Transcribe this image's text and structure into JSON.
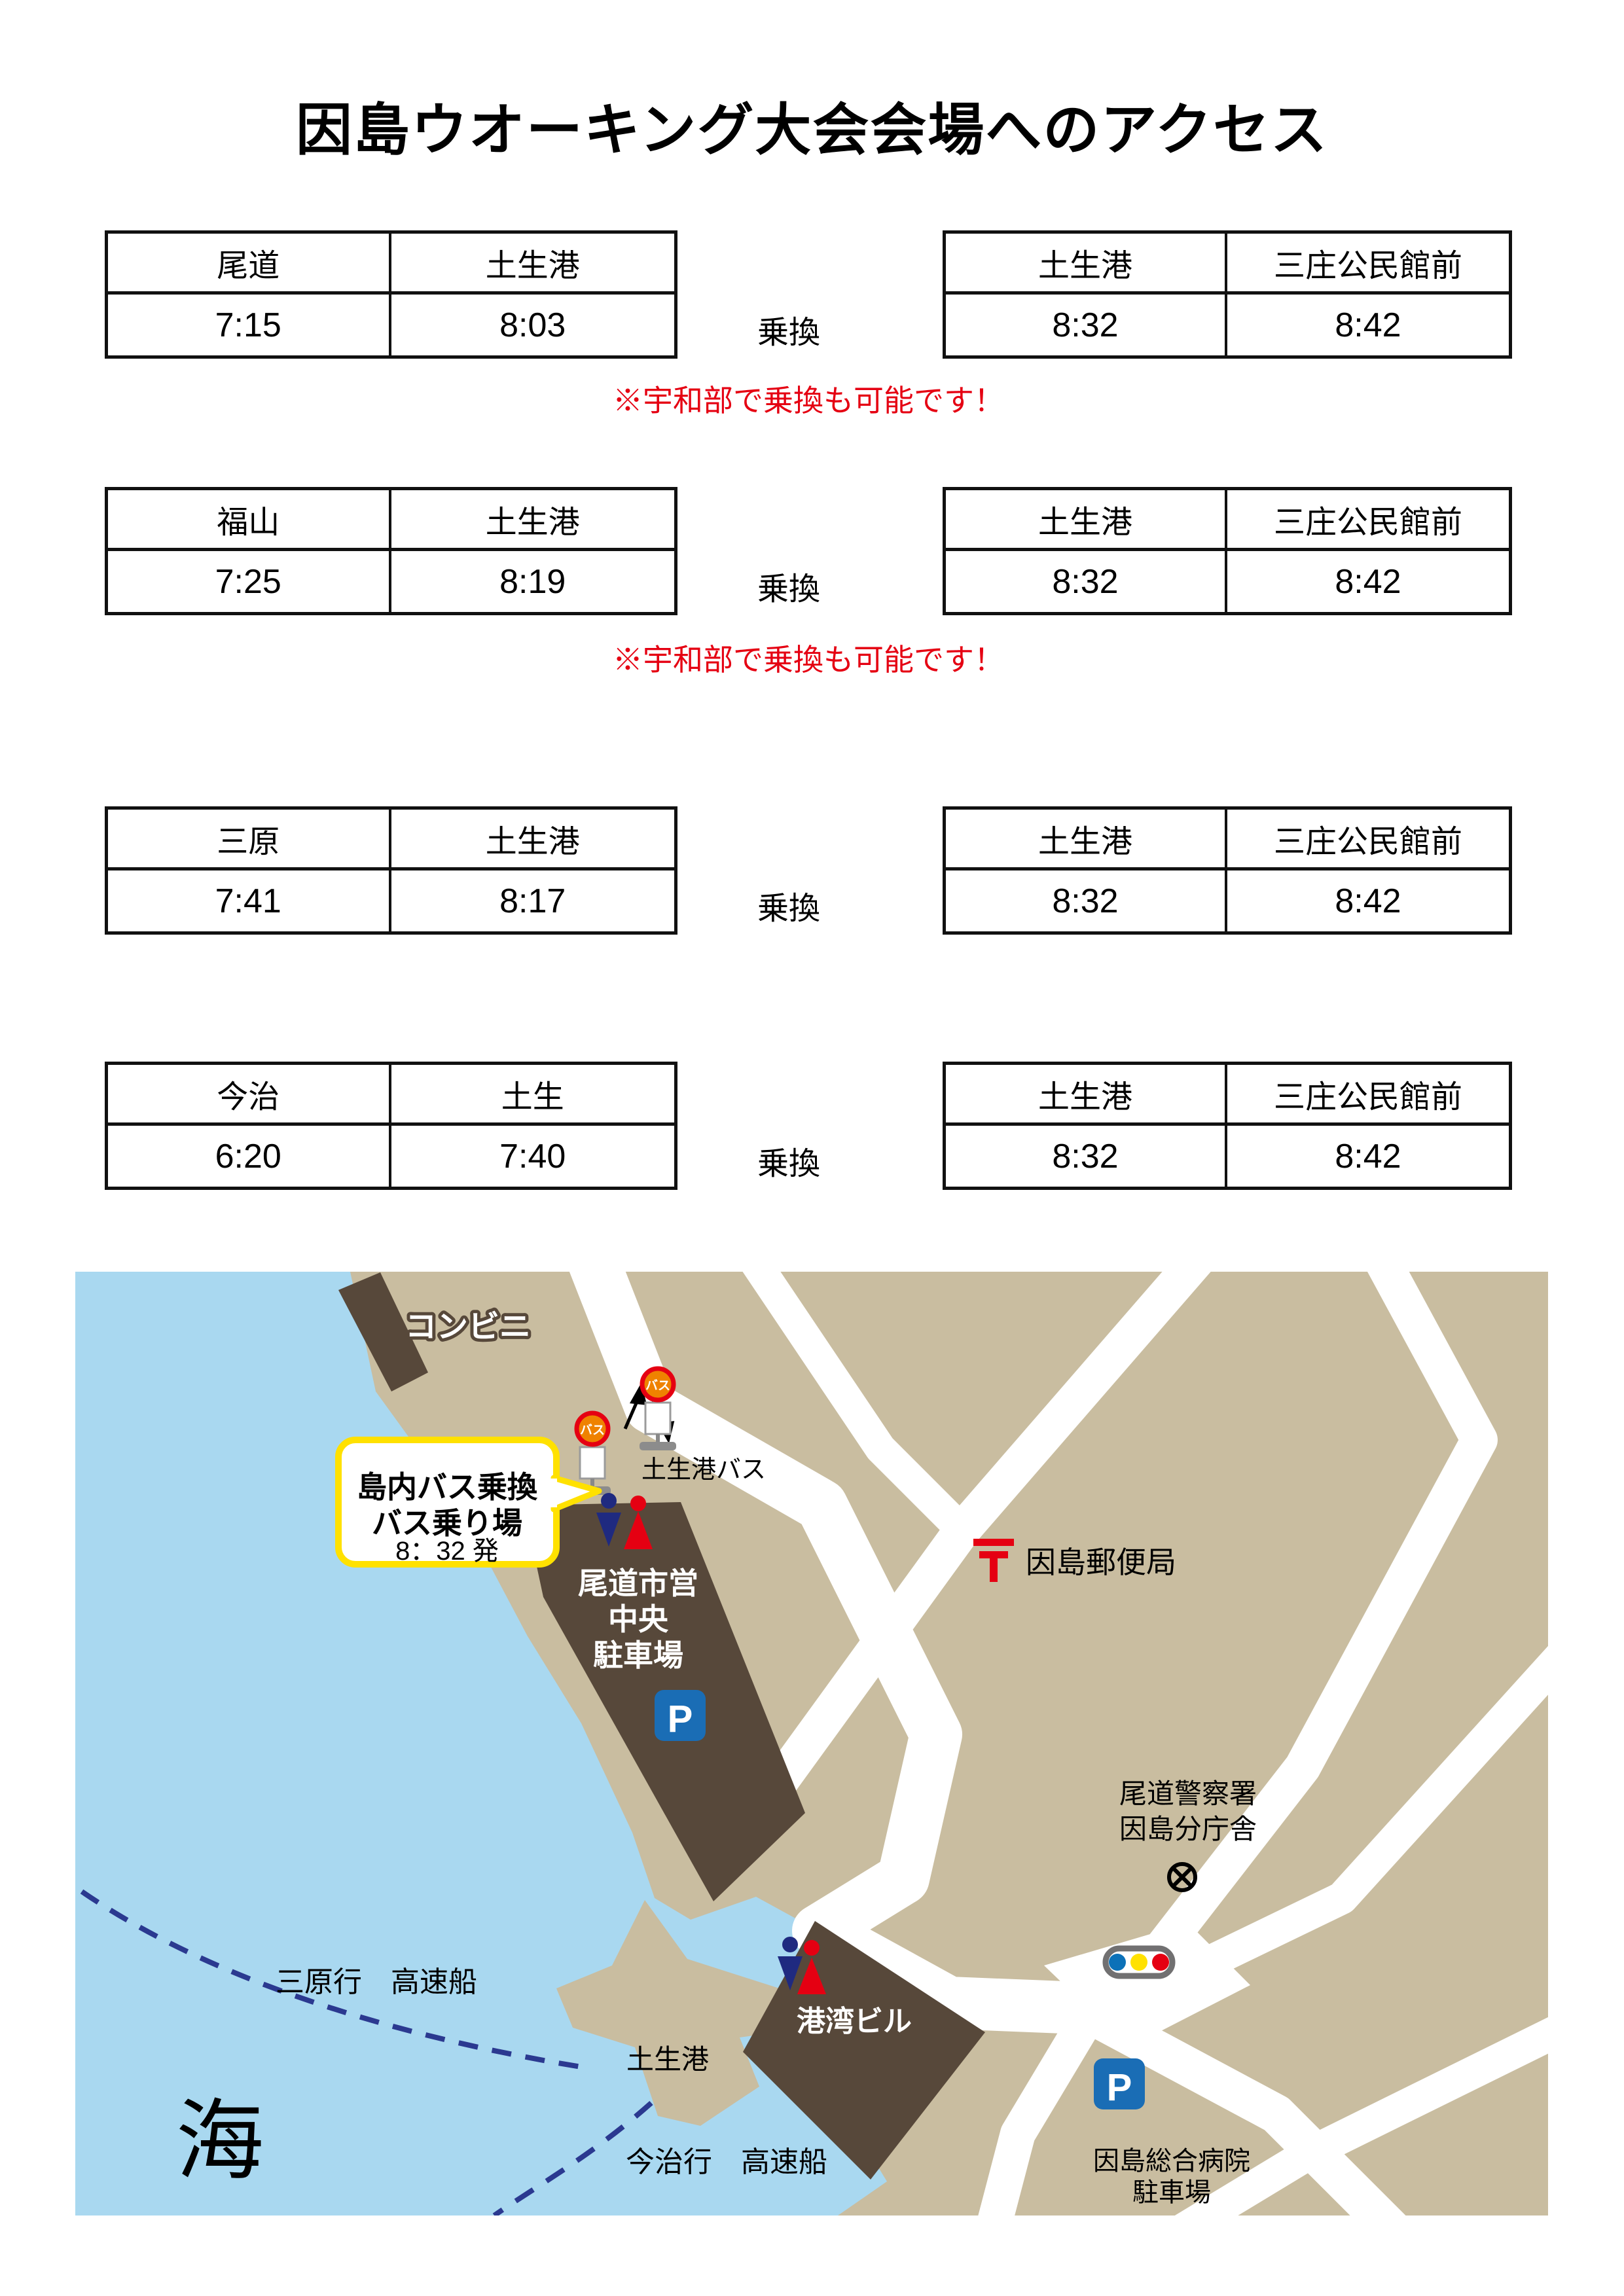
{
  "title": "因島ウオーキング大会会場へのアクセス",
  "rows": [
    {
      "left": {
        "from": "尾道",
        "to": "土生港",
        "dep": "7:15",
        "arr": "8:03"
      },
      "transfer": "乗換",
      "right": {
        "from": "土生港",
        "to": "三庄公民館前",
        "dep": "8:32",
        "arr": "8:42"
      },
      "note": "※宇和部で乗換も可能です！"
    },
    {
      "left": {
        "from": "福山",
        "to": "土生港",
        "dep": "7:25",
        "arr": "8:19"
      },
      "transfer": "乗換",
      "right": {
        "from": "土生港",
        "to": "三庄公民館前",
        "dep": "8:32",
        "arr": "8:42"
      },
      "note": "※宇和部で乗換も可能です！"
    },
    {
      "left": {
        "from": "三原",
        "to": "土生港",
        "dep": "7:41",
        "arr": "8:17"
      },
      "transfer": "乗換",
      "right": {
        "from": "土生港",
        "to": "三庄公民館前",
        "dep": "8:32",
        "arr": "8:42"
      }
    },
    {
      "left": {
        "from": "今治",
        "to": "土生",
        "dep": "6:20",
        "arr": "7:40"
      },
      "transfer": "乗換",
      "right": {
        "from": "土生港",
        "to": "三庄公民館前",
        "dep": "8:32",
        "arr": "8:42"
      }
    }
  ],
  "map": {
    "labels": {
      "convenience": "コンビニ",
      "callout_line1": "島内バス乗換",
      "callout_line2": "バス乗り場",
      "callout_line3": "8：32 発",
      "bus_sign": "バス",
      "habu_port_bus": "土生港バス",
      "post_office": "因島郵便局",
      "parking_line1": "尾道市営",
      "parking_line2": "中央",
      "parking_line3": "駐車場",
      "p": "P",
      "police_line1": "尾道警察署",
      "police_line2": "因島分庁舎",
      "harbor_building": "港湾ビル",
      "habu_port": "土生港",
      "sea": "海",
      "route_mihara": "三原行　高速船",
      "route_imabari": "今治行　高速船",
      "hospital_line1": "因島総合病院",
      "hospital_line2": "駐車場"
    },
    "colors": {
      "sea": "#a9d8f0",
      "land": "#c9bda0",
      "building": "#57483a",
      "road": "#ffffff",
      "route": "#2b3990",
      "callout_border": "#ffe100",
      "note_red": "#e50012",
      "parking_blue": "#1a6db5",
      "toilet_man": "#1f2a80",
      "toilet_woman": "#e50012",
      "signal_blue": "#0c71b8",
      "signal_yellow": "#ffe100",
      "signal_red": "#e50012",
      "signal_frame": "#717071",
      "bus_sign_ring": "#e50012",
      "bus_sign_fill": "#ef8200",
      "post_red": "#e50012"
    }
  }
}
